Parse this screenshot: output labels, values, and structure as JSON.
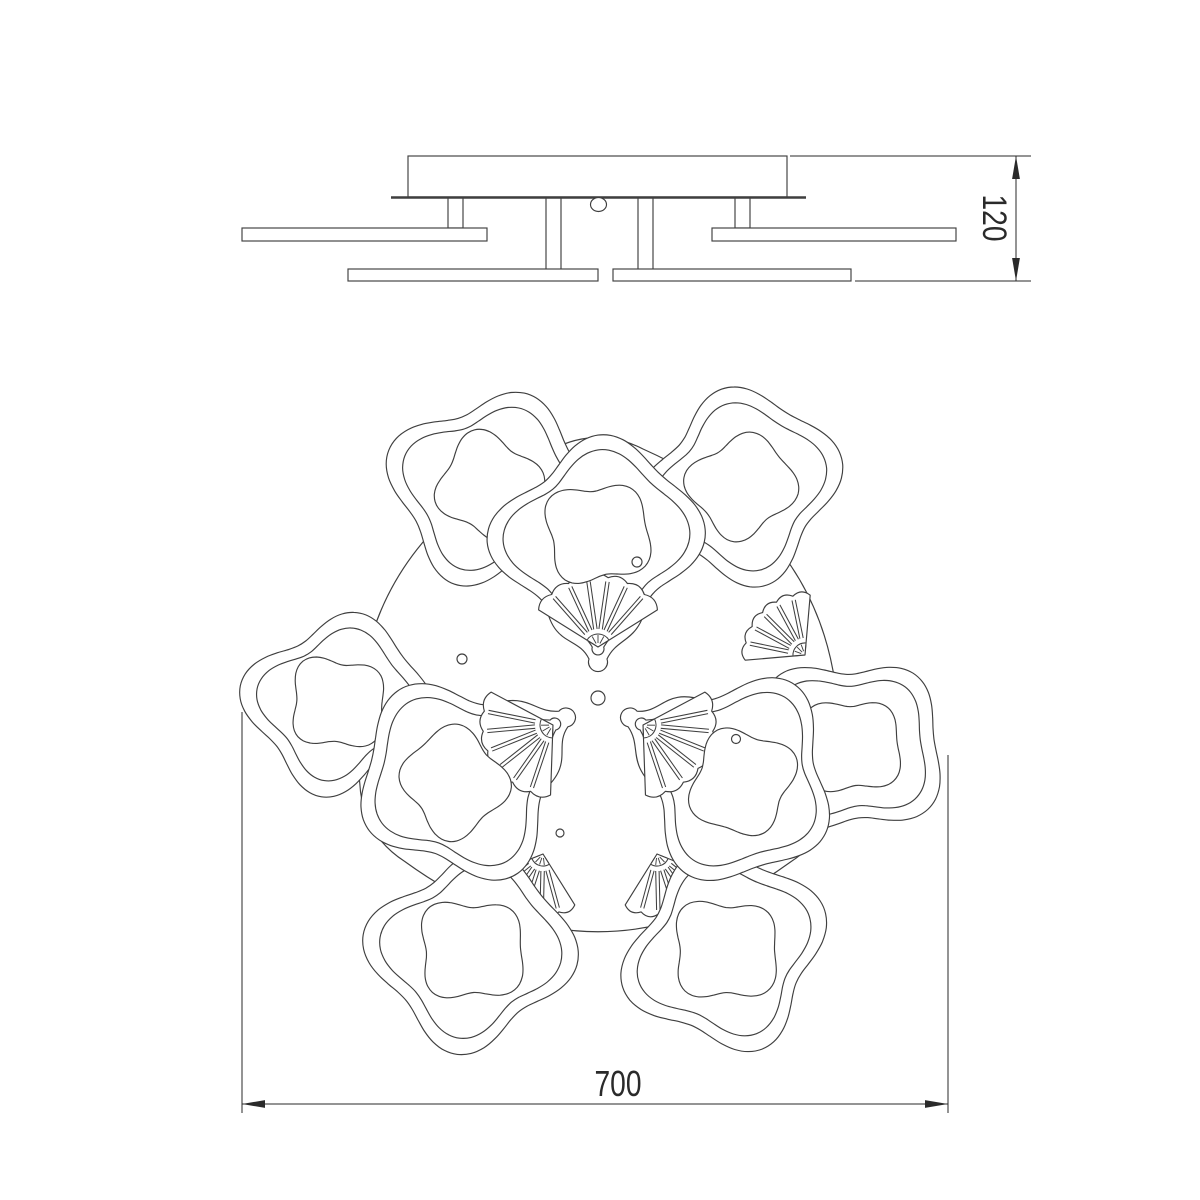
{
  "page": {
    "title": "ceiling-chandelier-technical-drawing",
    "background": "#ffffff"
  },
  "labels": {
    "height_dim": "120",
    "width_dim": "700"
  },
  "style": {
    "line_color": "#3f3f3f",
    "dim_color": "#2a2a2a",
    "fill": "#ffffff",
    "line_width": 1.15,
    "dim_width": 1,
    "font_size": 36,
    "font_size_v": 34,
    "text_length": 47
  },
  "side_view": {
    "canopy": {
      "x": 408,
      "y": 156,
      "w": 379,
      "h": 41
    },
    "baseline": {
      "x1": 391,
      "x2": 806,
      "y": 197.5,
      "width": 2.6
    },
    "knob": {
      "cx": 598.5,
      "cy": 204.5,
      "rx": 8,
      "ry": 7
    },
    "stems": [
      {
        "x": 448,
        "w": 15,
        "y1": 197,
        "y2": 228
      },
      {
        "x": 546,
        "w": 15,
        "y1": 197,
        "y2": 270
      },
      {
        "x": 638,
        "w": 15,
        "y1": 197,
        "y2": 270
      },
      {
        "x": 735,
        "w": 15,
        "y1": 197,
        "y2": 228
      }
    ],
    "arms": [
      {
        "x": 242,
        "y": 228,
        "w": 245,
        "h": 13
      },
      {
        "x": 348,
        "y": 269,
        "w": 250,
        "h": 12
      },
      {
        "x": 613,
        "y": 269,
        "w": 238,
        "h": 12
      },
      {
        "x": 712,
        "y": 228,
        "w": 244,
        "h": 13
      }
    ]
  },
  "dim_height": {
    "line_x": 1016,
    "y1": 156,
    "y2": 281,
    "ext_top": {
      "x1": 790,
      "x2": 1031,
      "y": 156
    },
    "ext_bottom": {
      "x1": 855,
      "x2": 1031,
      "y": 281
    },
    "text": {
      "x": 994,
      "y": 218
    }
  },
  "plan_view": {
    "rot_center": {
      "x": 598,
      "y": 699
    },
    "base_plate": {
      "cx": 598,
      "cy": 698,
      "r_vertex": 272,
      "r_edge": 220
    },
    "ring_inset": 16,
    "island_scale": 0.55,
    "outer_plates": [
      {
        "cx": 490,
        "cy": 487,
        "r": 101,
        "rot": 20,
        "irot": 55
      },
      {
        "cx": 742,
        "cy": 486,
        "r": 100,
        "rot": -12,
        "irot": 20
      },
      {
        "cx": 338,
        "cy": 703,
        "r": 93,
        "rot": 10,
        "irot": 40
      },
      {
        "cx": 852,
        "cy": 746,
        "r": 96,
        "rot": 40,
        "irot": 0
      },
      {
        "cx": 472,
        "cy": 950,
        "r": 103,
        "rot": 8,
        "irot": 35
      },
      {
        "cx": 726,
        "cy": 950,
        "r": 103,
        "rot": -20,
        "irot": 65
      }
    ],
    "outer_fans": [
      {
        "x": 470,
        "y": 565,
        "aim": 315
      },
      {
        "x": 700,
        "y": 554,
        "aim": 338
      },
      {
        "x": 427,
        "y": 693,
        "aim": 140
      },
      {
        "x": 805,
        "y": 655,
        "aim": 225
      },
      {
        "x": 543,
        "y": 854,
        "aim": 108
      },
      {
        "x": 657,
        "y": 854,
        "aim": 72
      }
    ],
    "fan_defaults": {
      "spread": 100,
      "r_out": 60,
      "r_cap": 12,
      "ribs": 6
    },
    "inner_plate": {
      "cx": 598,
      "cy": 538,
      "r": 104,
      "ring_r": 89,
      "island": {
        "cy": 533,
        "r": 56,
        "rot": 35
      },
      "tip": {
        "x": 598,
        "y": 662,
        "r": 9.5
      },
      "ring_tip": {
        "x": 598,
        "y": 649,
        "r": 6
      },
      "join_a": 52,
      "join_b": 128,
      "fan": {
        "x": 598,
        "y": 647,
        "aim": 270,
        "spread": 116,
        "r_out": 70,
        "r_cap": 13,
        "ribs": 7
      },
      "rotations": [
        0,
        120,
        -120
      ]
    },
    "holes": [
      {
        "x": 598,
        "y": 698,
        "r": 7
      },
      {
        "x": 462,
        "y": 659,
        "r": 5
      },
      {
        "x": 637,
        "y": 562,
        "r": 5
      },
      {
        "x": 736,
        "y": 739,
        "r": 4.5
      },
      {
        "x": 560,
        "y": 833,
        "r": 4
      }
    ]
  },
  "dim_width": {
    "line_y": 1104,
    "x1": 242,
    "x2": 948,
    "ext_left": {
      "x": 242,
      "y1": 712,
      "y2": 1113
    },
    "ext_right": {
      "x": 948,
      "y1": 755,
      "y2": 1113
    },
    "text": {
      "x": 618,
      "y": 1096
    }
  }
}
